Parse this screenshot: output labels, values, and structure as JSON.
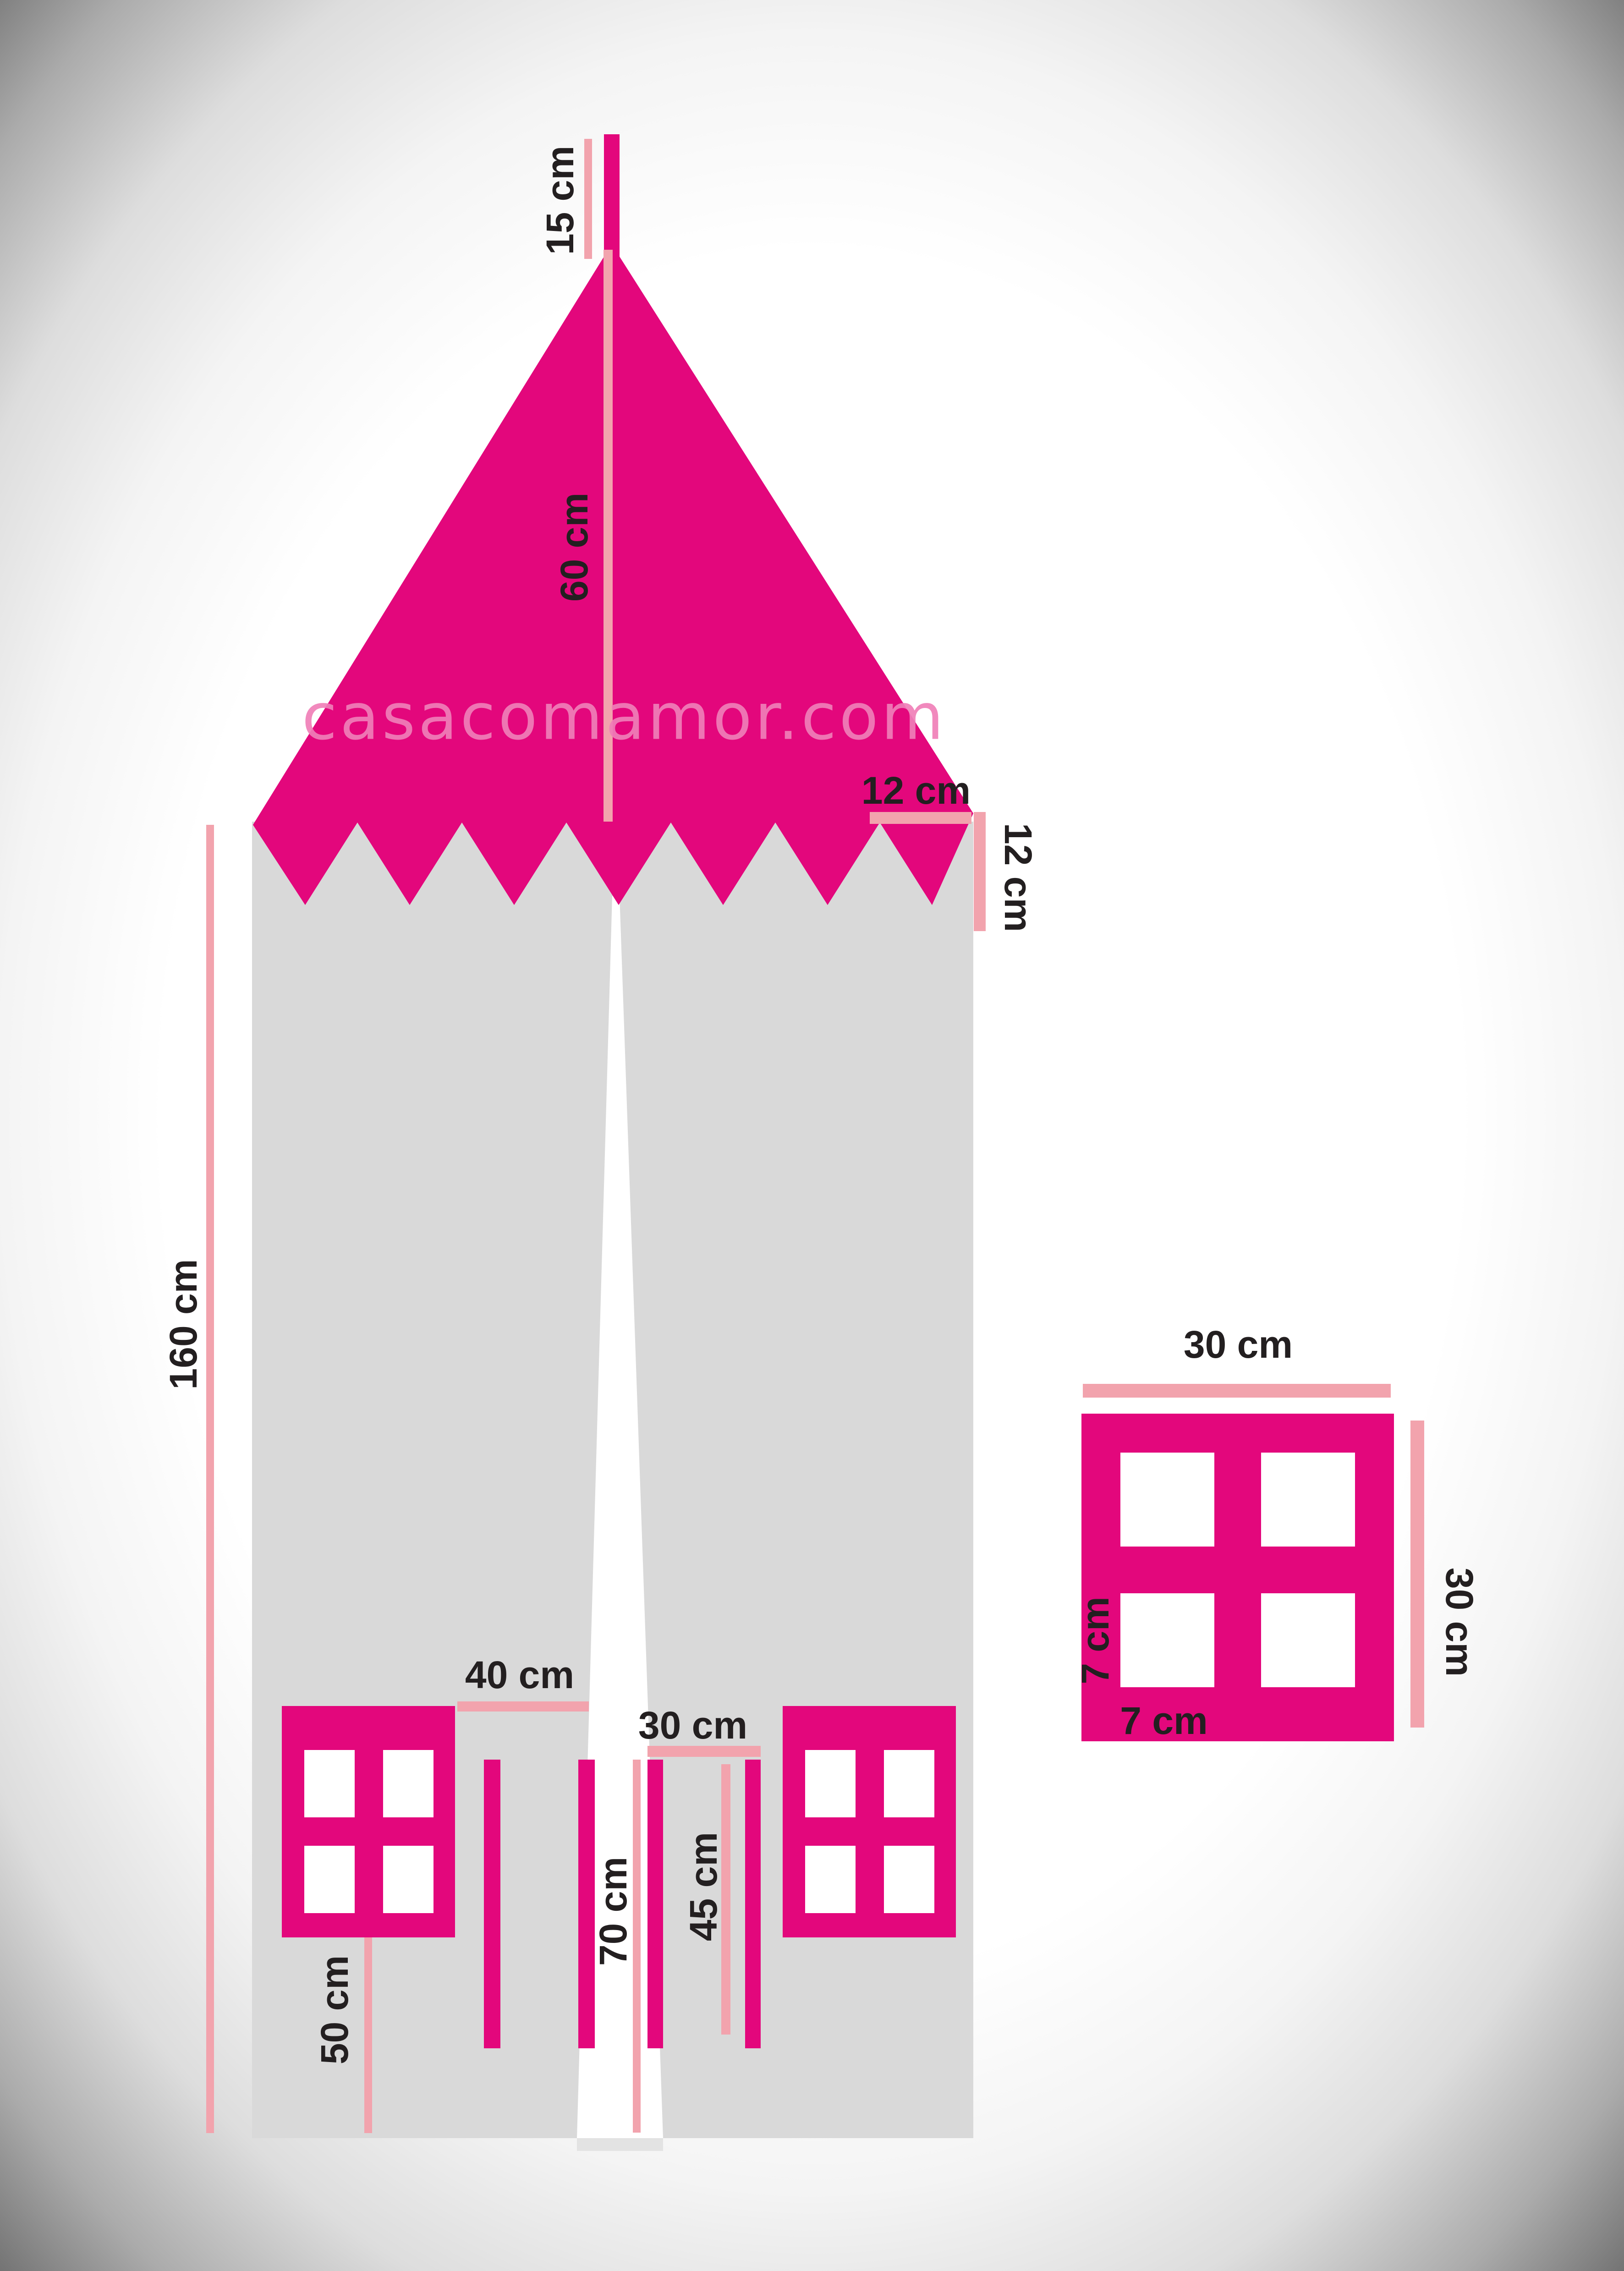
{
  "watermark": {
    "text": "casacomamor.com"
  },
  "colors": {
    "magenta": "#E3077C",
    "light_pink": "#F2A3AD",
    "body_gray": "#D9D9D9",
    "slit_tab_gray": "#E3E3E3",
    "label_black": "#231F20",
    "watermark_pink": "#F07FB8"
  },
  "measurements": {
    "pole_height": "15 cm",
    "roof_height": "60 cm",
    "scallop_width": "12 cm",
    "scallop_height": "12 cm",
    "body_height": "160 cm",
    "patch_width": "30 cm",
    "patch_height": "30 cm",
    "pane_height": "7 cm",
    "pane_width": "7 cm",
    "window_gap": "40 cm",
    "door_width": "30 cm",
    "door_height": "70 cm",
    "tie_length": "45 cm",
    "window_drop": "50 cm"
  }
}
